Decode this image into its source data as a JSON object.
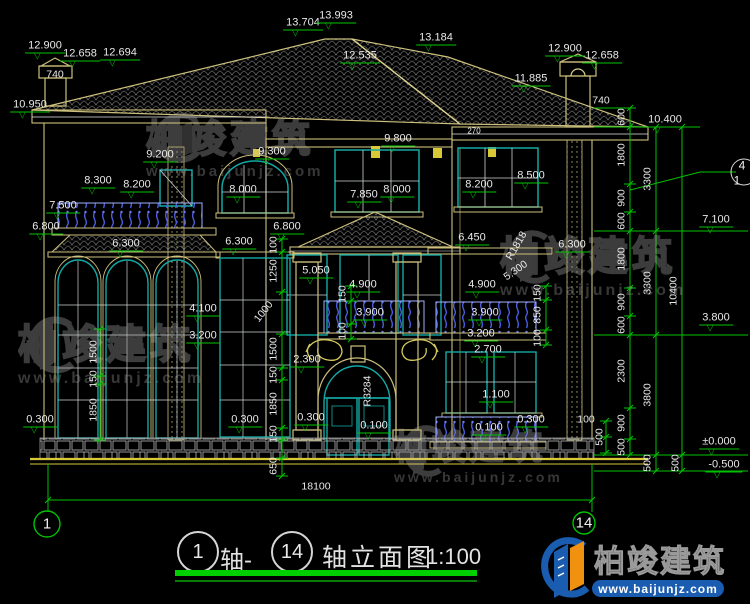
{
  "drawing": {
    "scale_note": "1:100",
    "overall_width_dim": "18100"
  },
  "title_block": {
    "axis_a": "1",
    "join_text": "轴-",
    "axis_b": "14",
    "title_text": "轴立面图",
    "scale": "1:100"
  },
  "brand": {
    "name": "柏竣建筑",
    "url": "www.baijunjz.com"
  },
  "grid_bubbles": {
    "left": "1",
    "right": "14",
    "detail_top": "4",
    "detail_bottom": "1"
  },
  "colors": {
    "background": "#000000",
    "cad_green": "#00c400",
    "cad_tan": "#cdc07c",
    "window_teal": "#13a8a4",
    "railing_blue": "#4b5ce0",
    "logo_blue": "#1a5cb0",
    "logo_orange": "#f0920f",
    "text_white": "#e9e9e9"
  },
  "labels": [
    {
      "t": "12.900",
      "x": 45,
      "y": 47,
      "cls": "lv"
    },
    {
      "t": "12.658",
      "x": 80,
      "y": 55,
      "cls": "lv"
    },
    {
      "t": "12.694",
      "x": 120,
      "y": 54,
      "cls": "lv"
    },
    {
      "t": "10.950",
      "x": 30,
      "y": 106,
      "cls": "lv"
    },
    {
      "t": "13.704",
      "x": 303,
      "y": 24,
      "cls": "lv"
    },
    {
      "t": "13.993",
      "x": 336,
      "y": 17,
      "cls": "lv"
    },
    {
      "t": "12.535",
      "x": 360,
      "y": 57,
      "cls": "lv"
    },
    {
      "t": "13.184",
      "x": 436,
      "y": 39,
      "cls": "lv"
    },
    {
      "t": "11.885",
      "x": 531,
      "y": 80,
      "cls": "lv"
    },
    {
      "t": "12.900",
      "x": 565,
      "y": 50,
      "cls": "lv"
    },
    {
      "t": "12.658",
      "x": 602,
      "y": 57,
      "cls": "lv"
    },
    {
      "t": "10.400",
      "x": 665,
      "y": 121,
      "cls": "lv"
    },
    {
      "t": "9.800",
      "x": 398,
      "y": 140,
      "cls": "lv"
    },
    {
      "t": "9.300",
      "x": 272,
      "y": 153,
      "cls": "lv"
    },
    {
      "t": "9.200",
      "x": 160,
      "y": 156,
      "cls": "lv"
    },
    {
      "t": "8.300",
      "x": 98,
      "y": 182,
      "cls": "lv"
    },
    {
      "t": "8.200",
      "x": 137,
      "y": 186,
      "cls": "lv"
    },
    {
      "t": "8.000",
      "x": 243,
      "y": 191,
      "cls": "lv"
    },
    {
      "t": "7.850",
      "x": 364,
      "y": 196,
      "cls": "lv"
    },
    {
      "t": "8.000",
      "x": 397,
      "y": 191,
      "cls": "lv"
    },
    {
      "t": "8.200",
      "x": 479,
      "y": 186,
      "cls": "lv"
    },
    {
      "t": "8.500",
      "x": 531,
      "y": 177,
      "cls": "lv"
    },
    {
      "t": "7.500",
      "x": 63,
      "y": 207,
      "cls": "lv"
    },
    {
      "t": "6.800",
      "x": 46,
      "y": 228,
      "cls": "lv"
    },
    {
      "t": "6.800",
      "x": 287,
      "y": 228,
      "cls": "lv"
    },
    {
      "t": "6.300",
      "x": 126,
      "y": 245,
      "cls": "lv"
    },
    {
      "t": "6.300",
      "x": 239,
      "y": 243,
      "cls": "lv"
    },
    {
      "t": "6.450",
      "x": 472,
      "y": 239,
      "cls": "lv"
    },
    {
      "t": "6.300",
      "x": 572,
      "y": 246,
      "cls": "lv"
    },
    {
      "t": "5.050",
      "x": 316,
      "y": 272,
      "cls": "lv"
    },
    {
      "t": "4.900",
      "x": 363,
      "y": 286,
      "cls": "lv"
    },
    {
      "t": "4.900",
      "x": 482,
      "y": 286,
      "cls": "lv"
    },
    {
      "t": "4.100",
      "x": 203,
      "y": 310,
      "cls": "lv"
    },
    {
      "t": "3.200",
      "x": 203,
      "y": 337,
      "cls": "lv"
    },
    {
      "t": "3.900",
      "x": 370,
      "y": 314,
      "cls": "lv"
    },
    {
      "t": "3.900",
      "x": 485,
      "y": 314,
      "cls": "lv"
    },
    {
      "t": "3.200",
      "x": 481,
      "y": 335,
      "cls": "lv"
    },
    {
      "t": "2.700",
      "x": 488,
      "y": 351,
      "cls": "lv"
    },
    {
      "t": "2.300",
      "x": 307,
      "y": 361,
      "cls": "lv"
    },
    {
      "t": "1.100",
      "x": 496,
      "y": 396,
      "cls": "lv"
    },
    {
      "t": "0.300",
      "x": 40,
      "y": 421,
      "cls": "lv"
    },
    {
      "t": "0.300",
      "x": 245,
      "y": 421,
      "cls": "lv"
    },
    {
      "t": "0.300",
      "x": 311,
      "y": 419,
      "cls": "lv"
    },
    {
      "t": "0.100",
      "x": 374,
      "y": 427,
      "cls": "lv"
    },
    {
      "t": "0.100",
      "x": 489,
      "y": 429,
      "cls": "lv"
    },
    {
      "t": "0.300",
      "x": 531,
      "y": 421,
      "cls": "lv"
    },
    {
      "t": "7.100",
      "x": 716,
      "y": 221,
      "cls": "lv"
    },
    {
      "t": "3.800",
      "x": 716,
      "y": 319,
      "cls": "lv"
    },
    {
      "t": "±0.000",
      "x": 719,
      "y": 443,
      "cls": "lv"
    },
    {
      "t": "-0.500",
      "x": 724,
      "y": 466,
      "cls": "lv"
    },
    {
      "t": "600",
      "x": 622,
      "y": 117,
      "cls": "vd"
    },
    {
      "t": "1800",
      "x": 622,
      "y": 155,
      "cls": "vd"
    },
    {
      "t": "900",
      "x": 622,
      "y": 198,
      "cls": "vd"
    },
    {
      "t": "600",
      "x": 622,
      "y": 221,
      "cls": "vd"
    },
    {
      "t": "1800",
      "x": 622,
      "y": 259,
      "cls": "vd"
    },
    {
      "t": "900",
      "x": 622,
      "y": 302,
      "cls": "vd"
    },
    {
      "t": "600",
      "x": 622,
      "y": 325,
      "cls": "vd"
    },
    {
      "t": "2300",
      "x": 622,
      "y": 371,
      "cls": "vd"
    },
    {
      "t": "900",
      "x": 622,
      "y": 423,
      "cls": "vd"
    },
    {
      "t": "500",
      "x": 622,
      "y": 447,
      "cls": "vd"
    },
    {
      "t": "3300",
      "x": 648,
      "y": 179,
      "cls": "vd"
    },
    {
      "t": "3300",
      "x": 648,
      "y": 283,
      "cls": "vd"
    },
    {
      "t": "3800",
      "x": 648,
      "y": 395,
      "cls": "vd"
    },
    {
      "t": "500",
      "x": 648,
      "y": 463,
      "cls": "vd"
    },
    {
      "t": "10400",
      "x": 674,
      "y": 291,
      "cls": "vd"
    },
    {
      "t": "500",
      "x": 676,
      "y": 463,
      "cls": "vd"
    },
    {
      "t": "100",
      "x": 274,
      "y": 245,
      "cls": "vd"
    },
    {
      "t": "1250",
      "x": 274,
      "y": 271,
      "cls": "vd"
    },
    {
      "t": "1500",
      "x": 274,
      "y": 349,
      "cls": "vd"
    },
    {
      "t": "150",
      "x": 274,
      "y": 375,
      "cls": "vd"
    },
    {
      "t": "1850",
      "x": 274,
      "y": 404,
      "cls": "vd"
    },
    {
      "t": "150",
      "x": 274,
      "y": 434,
      "cls": "vd"
    },
    {
      "t": "650",
      "x": 274,
      "y": 466,
      "cls": "vd"
    },
    {
      "t": "1500",
      "x": 94,
      "y": 352,
      "cls": "vd"
    },
    {
      "t": "150",
      "x": 94,
      "y": 379,
      "cls": "vd"
    },
    {
      "t": "1850",
      "x": 94,
      "y": 410,
      "cls": "vd"
    },
    {
      "t": "150",
      "x": 343,
      "y": 294,
      "cls": "vd"
    },
    {
      "t": "100",
      "x": 343,
      "y": 331,
      "cls": "vd"
    },
    {
      "t": "150",
      "x": 538,
      "y": 293,
      "cls": "vd"
    },
    {
      "t": "850",
      "x": 538,
      "y": 315,
      "cls": "vd"
    },
    {
      "t": "100",
      "x": 538,
      "y": 338,
      "cls": "vd"
    },
    {
      "t": "500",
      "x": 600,
      "y": 437,
      "cls": "vd"
    },
    {
      "t": "740",
      "x": 55,
      "y": 75,
      "cls": "dm"
    },
    {
      "t": "740",
      "x": 601,
      "y": 101,
      "cls": "dm"
    },
    {
      "t": "18100",
      "x": 316,
      "y": 487,
      "cls": "dm"
    },
    {
      "t": "100",
      "x": 586,
      "y": 420,
      "cls": "dm"
    },
    {
      "t": "270",
      "x": 474,
      "y": 131,
      "cls": "dm sm"
    },
    {
      "t": "R3284",
      "x": 368,
      "y": 391,
      "cls": "dm",
      "rot": -90
    },
    {
      "t": "1000",
      "x": 264,
      "y": 312,
      "cls": "dm",
      "rot": -52
    },
    {
      "t": "R1818",
      "x": 517,
      "y": 246,
      "cls": "dm",
      "rot": -60
    },
    {
      "t": "5.300",
      "x": 516,
      "y": 271,
      "cls": "dm",
      "rot": -35
    },
    {
      "t": "1",
      "x": 47,
      "y": 524,
      "cls": "bb"
    },
    {
      "t": "14",
      "x": 584,
      "y": 523,
      "cls": "bb"
    },
    {
      "t": "4",
      "x": 742,
      "y": 166,
      "cls": "det"
    },
    {
      "t": "1",
      "x": 737,
      "y": 181,
      "cls": "det"
    }
  ],
  "dim_chains": [
    {
      "x": 630,
      "ticks": [
        108,
        127,
        184,
        212,
        231,
        288,
        316,
        335,
        408,
        439,
        455
      ]
    },
    {
      "x": 656,
      "ticks": [
        127,
        231,
        335,
        455,
        471
      ]
    },
    {
      "x": 682,
      "ticks": [
        127,
        455,
        471
      ]
    },
    {
      "x": 282,
      "ticks": [
        239,
        252,
        292,
        334,
        368,
        380,
        428,
        440,
        458,
        476
      ]
    },
    {
      "x": 100,
      "ticks": [
        329,
        376,
        384,
        440
      ]
    },
    {
      "x": 351,
      "ticks": [
        286,
        301,
        324,
        339
      ]
    },
    {
      "x": 546,
      "ticks": [
        286,
        300,
        330,
        345
      ]
    },
    {
      "x": 606,
      "ticks": [
        421,
        437,
        453
      ]
    },
    {
      "y": 500,
      "ticks": [
        48,
        592
      ]
    }
  ]
}
